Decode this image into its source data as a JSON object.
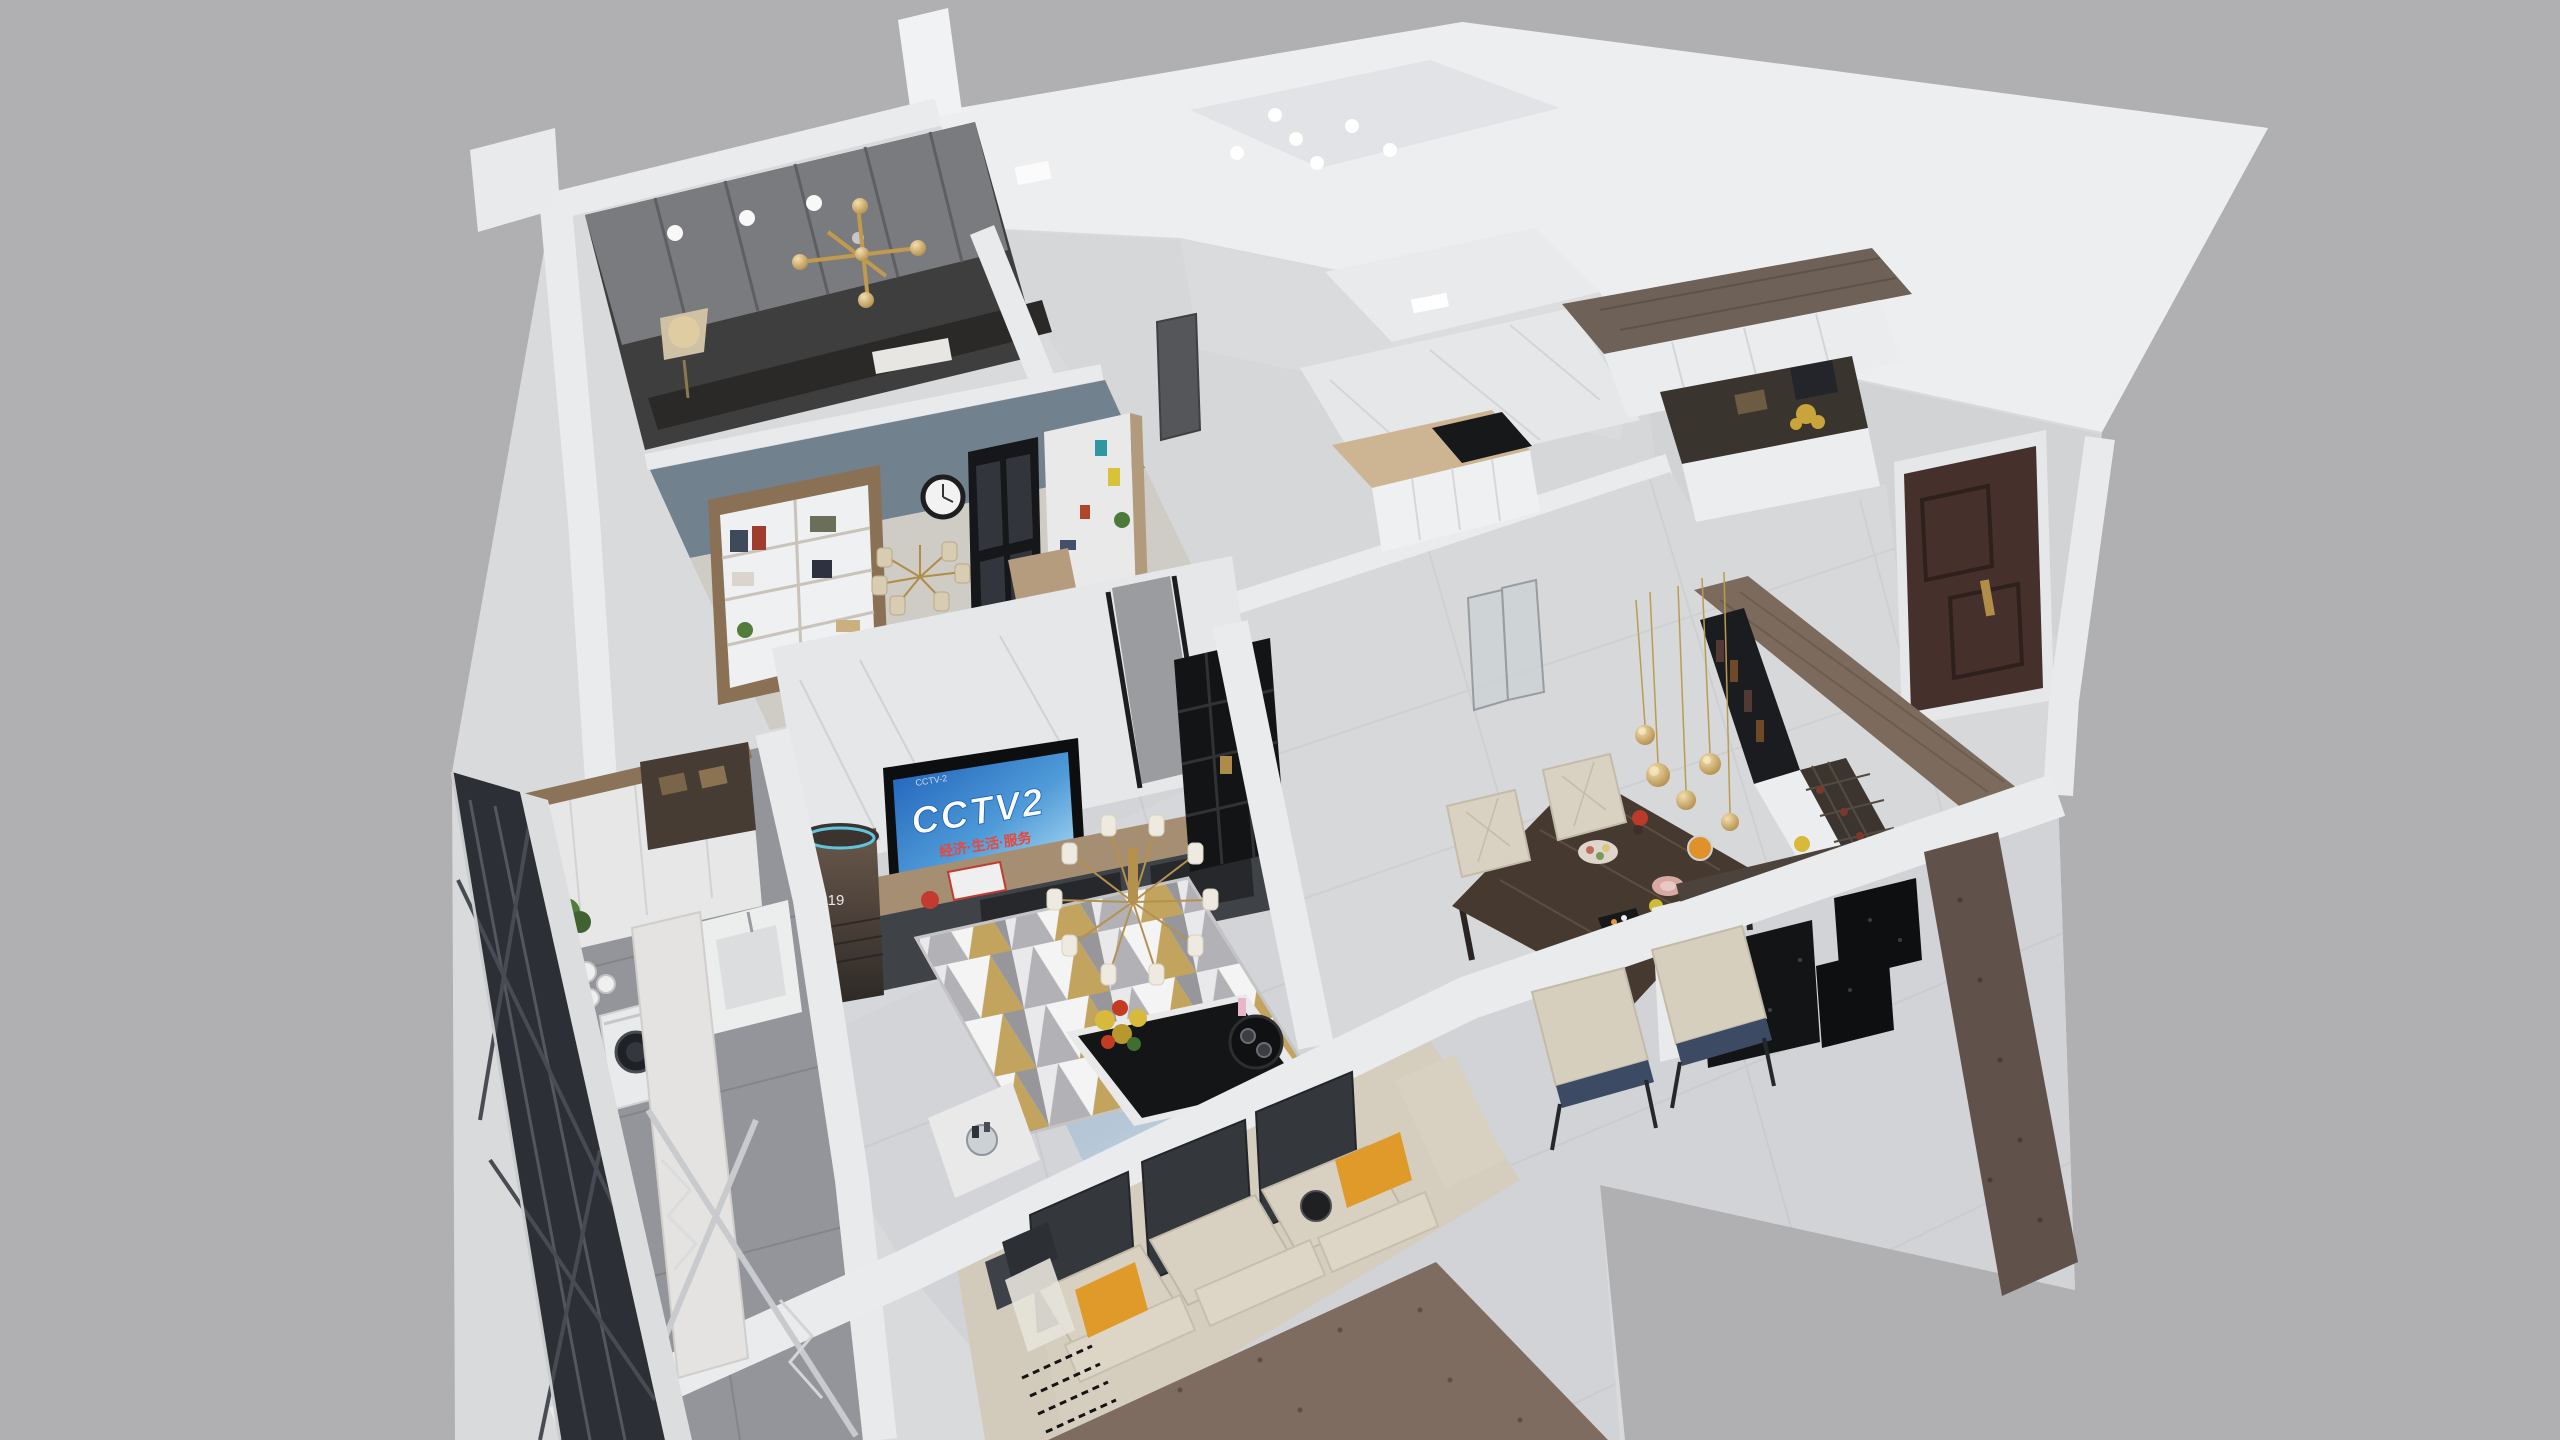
{
  "scene": {
    "type": "3d-apartment-cutaway-render",
    "view": "isometric dollhouse from above",
    "tv": {
      "logo": "CCTV2",
      "subtitle": "经济·生活·服务",
      "watermark": "CCTV-2"
    },
    "ac": {
      "display": "19"
    },
    "palette": {
      "background": "#b0b0b2",
      "wall_top": "#eaebed",
      "wall_face": "#d8d9db",
      "ceiling": "#edeef0",
      "ceiling_panel": "#e2e3e6",
      "floor_light": "#d3d4d7",
      "floor_hall": "#d7d8da",
      "floor_balcony": "#94959a",
      "wardrobe_gray": "#797b7e",
      "wall_blue": "#72818e",
      "marble_wall": "#e6e7e9",
      "wood_light": "#a68e72",
      "wood_dark": "#6e6157",
      "cabinet_white": "#ebeced",
      "black_panel": "#131416",
      "sofa_cream": "#d5cebe",
      "pillow_orange": "#e09a2a",
      "chair_navy": "#3c4a63",
      "chair_cream": "#d9d2c2",
      "table_marble": "#46392f",
      "door_brown": "#45302b",
      "gold": "#c09a4e",
      "screen_blue": "#2b6fc4",
      "slab_edge_brown": "#7d6c5f",
      "glazing_dark": "#2c2f35"
    },
    "rooms": [
      {
        "name": "master-bedroom",
        "items": [
          "wardrobe",
          "bed",
          "floor-lamp",
          "gold-wall-light",
          "downlights"
        ]
      },
      {
        "name": "study",
        "items": [
          "bookshelf",
          "wall-clock",
          "chandelier",
          "glass-partition",
          "desk"
        ]
      },
      {
        "name": "living-room",
        "items": [
          "tv",
          "tv-stand",
          "ac-tower",
          "chandelier",
          "rug",
          "coffee-table",
          "sofa",
          "leaning-panels",
          "pillows"
        ]
      },
      {
        "name": "kitchen",
        "items": [
          "marble-wall",
          "counter",
          "cooktop",
          "cabinets"
        ]
      },
      {
        "name": "bathroom",
        "items": [
          "ceiling-light"
        ]
      },
      {
        "name": "entry-hall",
        "items": [
          "shoe-cabinet",
          "decor-niche",
          "entry-door"
        ]
      },
      {
        "name": "dining-room",
        "items": [
          "marble-table",
          "dining-chairs",
          "pendant-lights",
          "wine-cabinet",
          "sideboard",
          "food"
        ]
      },
      {
        "name": "balcony-laundry",
        "items": [
          "cabinets",
          "washing-machine",
          "drying-rack",
          "towels",
          "plant",
          "glazing"
        ]
      }
    ]
  }
}
